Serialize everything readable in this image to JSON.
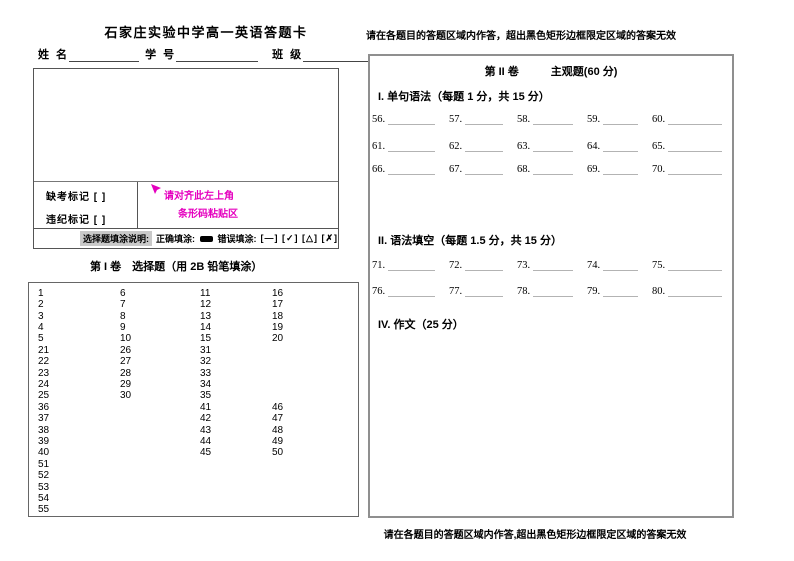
{
  "page": {
    "top_instruction": "请在各题目的答题区域内作答，超出黑色矩形边框限定区域的答案无效",
    "bottom_instruction": "请在各题目的答题区域内作答,超出黑色矩形边框限定区域的答案无效"
  },
  "left_page": {
    "title": "石家庄实验中学高一英语答题卡",
    "student_fields": [
      {
        "label": "姓 名"
      },
      {
        "label": "学 号"
      },
      {
        "label": "班 级"
      }
    ],
    "absent_mark_label": "缺考标记 [ ]",
    "violation_mark_label": "违纪标记 [ ]",
    "barcode_note_line1": "请对齐此左上角",
    "barcode_note_line2": "条形码粘贴区",
    "barcode_note_color": "#e500bf",
    "fill_note": {
      "label": "选择题填涂说明:",
      "correct_label": "正确填涂:",
      "wrong_label": "错误填涂:",
      "wrong_samples": "[—] [✓] [△] [✗]"
    },
    "section1_title": "第 I 卷　选择题（用 2B 铅笔填涂）",
    "answer_grid_blocks": [
      [
        [
          "1",
          "2",
          "3",
          "4",
          "5"
        ],
        [
          "6",
          "7",
          "8",
          "9",
          "10"
        ],
        [
          "11",
          "12",
          "13",
          "14",
          "15"
        ],
        [
          "16",
          "17",
          "18",
          "19",
          "20"
        ]
      ],
      [
        [
          "21",
          "22",
          "23",
          "24",
          "25"
        ],
        [
          "26",
          "27",
          "28",
          "29",
          "30"
        ],
        [
          "31",
          "32",
          "33",
          "34",
          "35"
        ],
        []
      ],
      [
        [
          "36",
          "37",
          "38",
          "39",
          "40"
        ],
        [],
        [
          "41",
          "42",
          "43",
          "44",
          "45"
        ],
        [
          "46",
          "47",
          "48",
          "49",
          "50"
        ]
      ],
      [
        [
          "51",
          "52",
          "53",
          "54",
          "55"
        ],
        [],
        [],
        []
      ]
    ]
  },
  "right_page": {
    "volume_title": "第 II 卷",
    "volume_subtitle": "主观题(60 分)",
    "sections": [
      {
        "heading": "I. 单句语法（每题 1 分，共 15 分）",
        "numbers": [
          "56",
          "57",
          "58",
          "59",
          "60",
          "61",
          "62",
          "63",
          "64",
          "65",
          "66",
          "67",
          "68",
          "69",
          "70"
        ]
      },
      {
        "heading": "II. 语法填空（每题 1.5 分，共 15 分）",
        "numbers": [
          "71",
          "72",
          "73",
          "74",
          "75",
          "76",
          "77",
          "78",
          "79",
          "80"
        ]
      },
      {
        "heading": "IV. 作文（25 分）",
        "numbers": []
      }
    ]
  }
}
